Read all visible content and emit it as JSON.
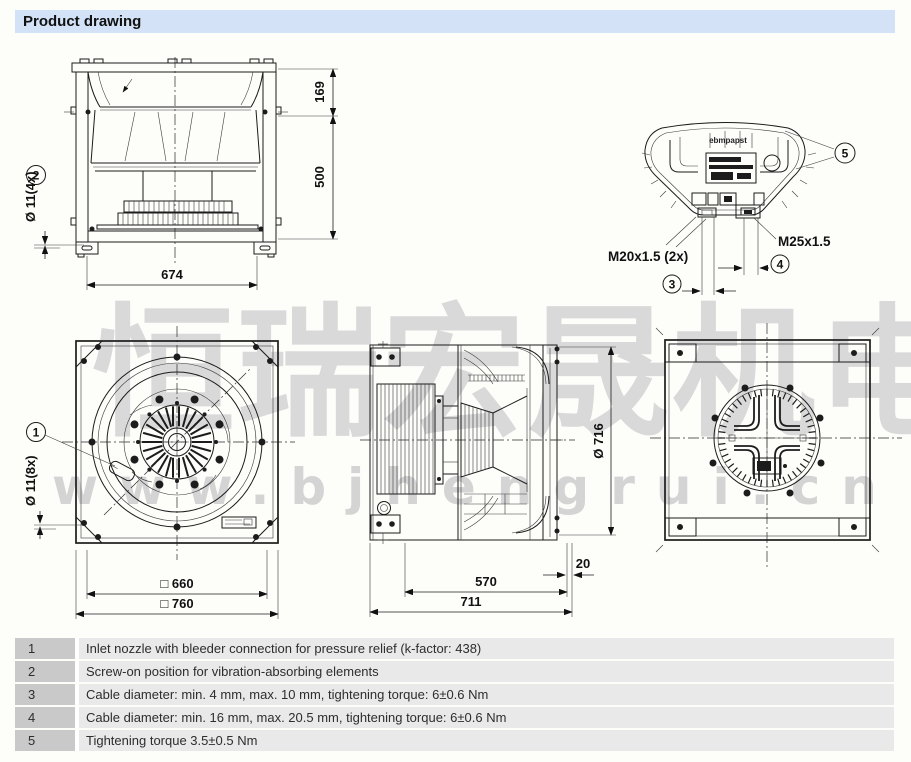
{
  "header": {
    "title": "Product drawing"
  },
  "watermark": {
    "cn": "恒瑞宏晟机电",
    "url": "www.bjhengrui.cn"
  },
  "colors": {
    "header_bg": "#d3e2f6",
    "legend_num_bg": "#c9c9c9",
    "legend_text_bg": "#e9e9e9",
    "watermark_grey": "#d7d7d7",
    "line_black": "#1c1c1c"
  },
  "drawings": {
    "side_view": {
      "dim_inlet_height": "169",
      "dim_housing_height": "500",
      "dim_width": "674",
      "hole_label": "Ø 11(4x)",
      "callout": "2"
    },
    "terminal_box": {
      "logo": "ebmpapst",
      "gland_left": "M20x1.5 (2x)",
      "gland_right": "M25x1.5",
      "callout_small_cable": "3",
      "callout_large_cable": "4",
      "callout_cover": "5"
    },
    "front_view": {
      "dim_inner_square": "□ 660",
      "dim_outer_square": "□ 760",
      "hole_label": "Ø 11(8x)",
      "callout": "1"
    },
    "depth_view": {
      "dim_diameter": "Ø 716",
      "dim_depth": "570",
      "dim_total_depth": "711",
      "dim_ring_offset": "20"
    }
  },
  "legend": {
    "rows": [
      {
        "num": "1",
        "text": "Inlet nozzle with bleeder connection for pressure relief (k-factor: 438)"
      },
      {
        "num": "2",
        "text": "Screw-on position for vibration-absorbing elements"
      },
      {
        "num": "3",
        "text": "Cable diameter: min. 4 mm, max. 10 mm, tightening torque: 6±0.6 Nm"
      },
      {
        "num": "4",
        "text": "Cable diameter: min. 16 mm, max. 20.5 mm, tightening torque: 6±0.6 Nm"
      },
      {
        "num": "5",
        "text": "Tightening torque 3.5±0.5 Nm"
      }
    ]
  }
}
